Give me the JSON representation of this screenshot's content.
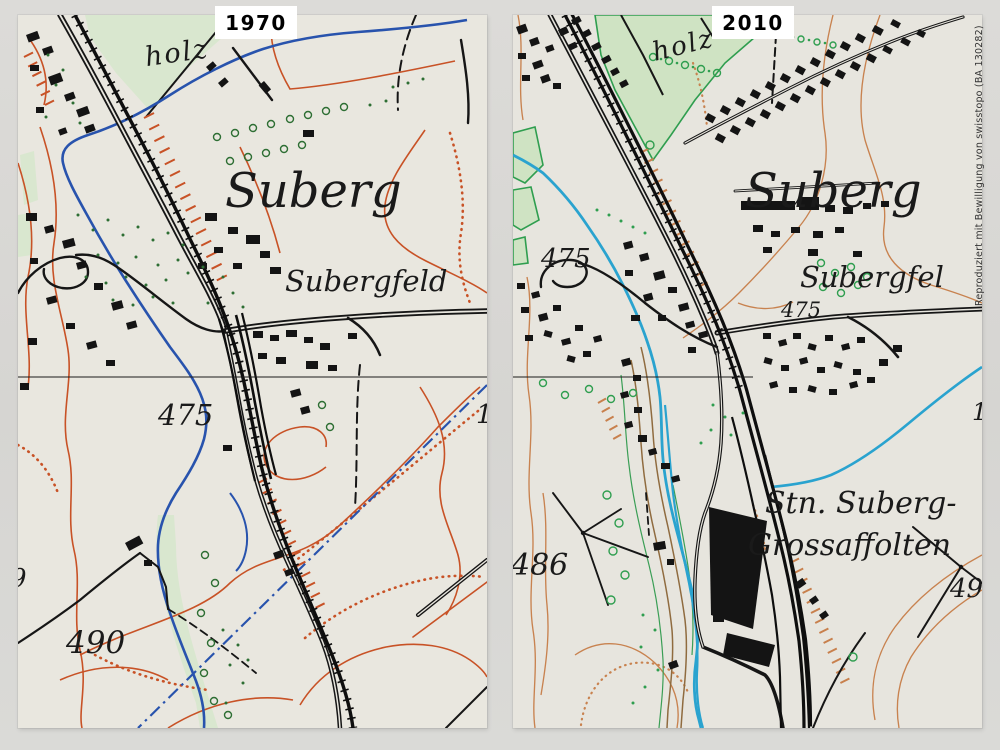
{
  "scene": {
    "background": "#d8d7d4",
    "paper_1970": "#e9e7df",
    "paper_2010": "#e7e5de"
  },
  "attribution": {
    "text": "Reproduziert mit Bewilligung von swisstopo (BA 130282)"
  },
  "panels": {
    "left": {
      "year": "1970",
      "labels": {
        "forest": "holz",
        "town": "Suberg",
        "field": "Subergfeld",
        "contour_475": "475",
        "contour_490": "490",
        "partial_left": "9",
        "partial_right": "1"
      }
    },
    "right": {
      "year": "2010",
      "labels": {
        "forest": "holz",
        "town": "Suberg",
        "field": "Subergfel",
        "contour_475_a": "475",
        "contour_475_b": "475",
        "contour_486": "486",
        "station_line1": "Stn. Suberg-",
        "station_line2": "Grossaffolten",
        "contour_49": "49",
        "partial_right": "1"
      }
    }
  },
  "colors": {
    "map1970_water": "#2853ad",
    "map1970_contour": "#c85226",
    "map1970_forest": "#d9e7cf",
    "map1970_orchard_green": "#2d6e33",
    "map2010_water": "#2aa3cf",
    "map2010_contour": "#c8824f",
    "map2010_forest": "#cfe3c3",
    "map2010_green": "#2f9e4f",
    "map2010_riparian_brown": "#8f6b3f",
    "ink_black": "#161616"
  }
}
